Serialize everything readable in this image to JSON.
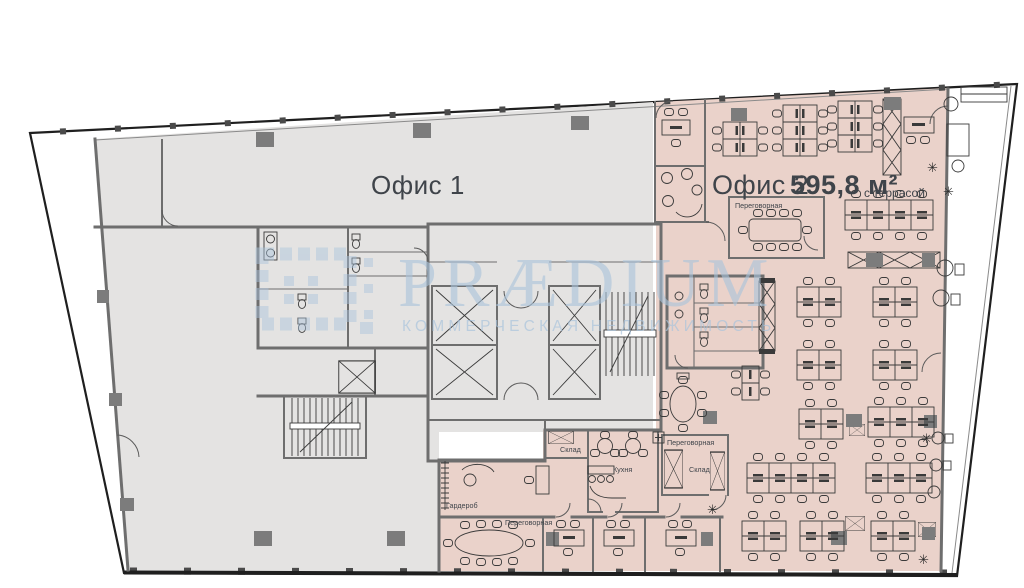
{
  "plan": {
    "office1": {
      "label": "Офис 1"
    },
    "office2": {
      "label": "Офис 2",
      "area": "595,8 м²",
      "terrace_note": "с террасой"
    },
    "rooms": {
      "meeting_room_top": "Переговорная",
      "meeting_room_mid": "Переговорная",
      "meeting_room_bottom": "Переговорная",
      "storage_top": "Склад",
      "storage_mid": "Склад",
      "kitchen": "Кухня",
      "wardrobe": "Гардероб"
    }
  },
  "watermark": {
    "title": "PRÆDIUM",
    "subtitle": "КОММЕРЧЕСКАЯ НЕДВИЖИМОСТЬ"
  },
  "colors": {
    "office1_fill": "#e4e3e2",
    "office2_fill": "#ead2ca",
    "wall": "#6e6e6e",
    "outline": "#1f1f1f",
    "column": "#7c7c7c",
    "furniture": "#3a3a3a",
    "watermark": "#a9c4dc",
    "label": "#3f444a",
    "tick": "#4a4a4a"
  }
}
